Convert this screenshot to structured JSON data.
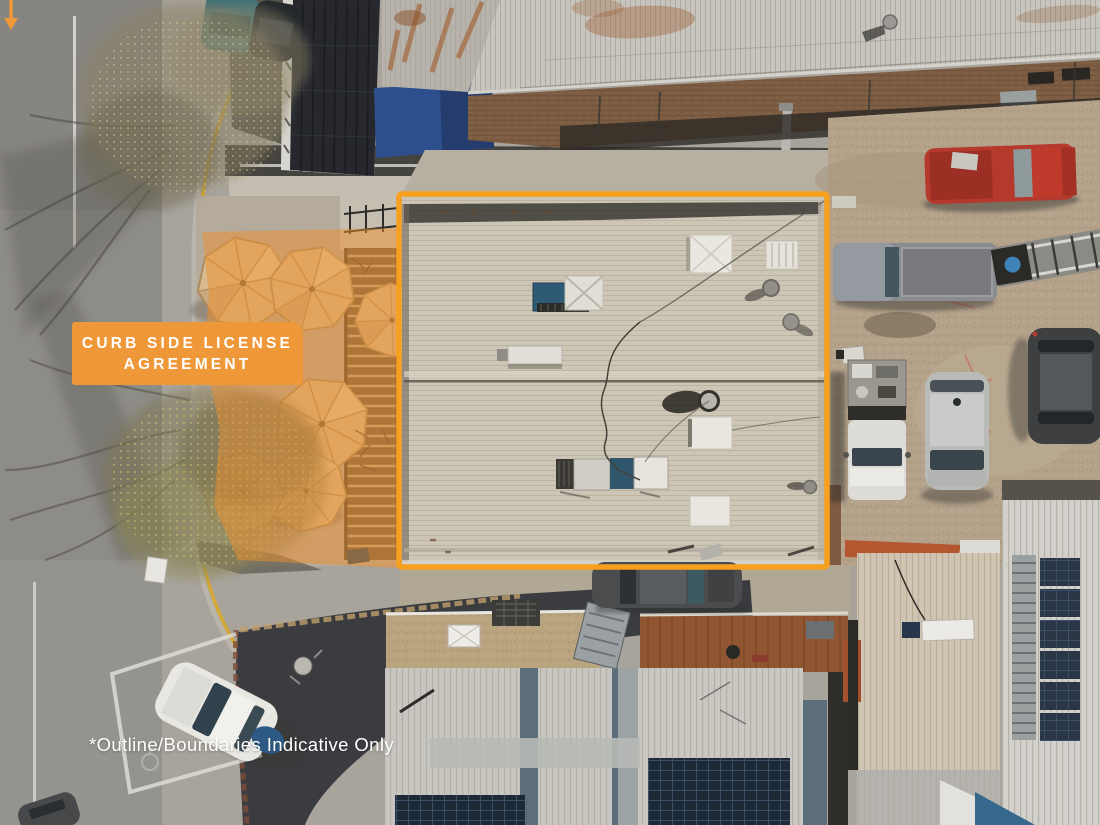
{
  "annotations": {
    "label": {
      "line1": "CURB SIDE LICENSE",
      "line2": "AGREEMENT"
    },
    "disclaimer": "*Outline/Boundaries Indicative Only",
    "colors": {
      "label_bg": "#EF9839",
      "label_text": "#FFFFFF",
      "outline_stroke": "#F7A01F",
      "overlay_fill": "#EE8F2E",
      "disclaimer_text": "#FFFFFF"
    }
  },
  "scene_palette": {
    "road": "#8E8C87",
    "footpath": "#A8A49C",
    "subject_roof": "#CDC6B7",
    "gravel_yard": "#B4A28B",
    "brick_wall": "#7C5C42",
    "rust_roof": "#8F5631",
    "umbrella": "#D9BA8E",
    "bluestone_paving": "#3A3C40"
  }
}
